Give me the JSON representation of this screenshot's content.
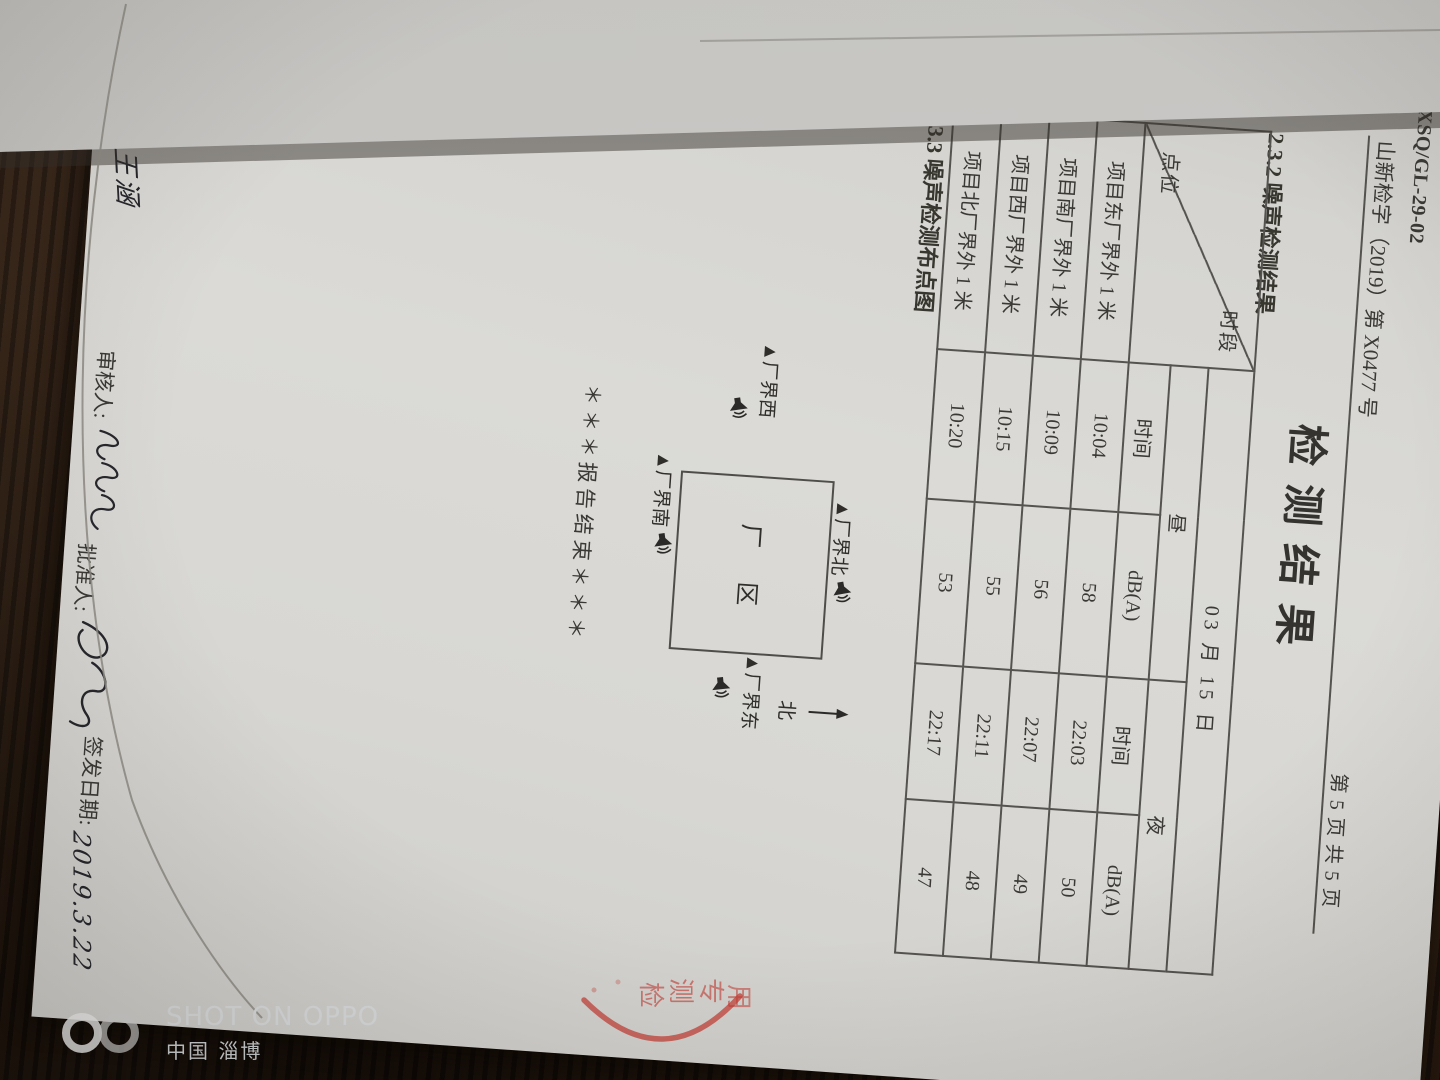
{
  "document": {
    "doc_code": "XSQ/GL-29-02",
    "ref_number": "山新检字（2019）第 X0477 号",
    "page_indicator": "第 5 页  共 5 页",
    "title": "检测结果",
    "section_232": "2.3.2  噪声检测结果",
    "section_233": "2.3.3  噪声检测布点图",
    "report_end": "＊＊＊报告结束＊＊＊",
    "table": {
      "corner_top_label": "时段",
      "corner_bottom_label": "点位",
      "date_header": "03 月 15 日",
      "day_label": "昼",
      "night_label": "夜",
      "time_label": "时间",
      "db_label": "dB(A)",
      "rows": [
        {
          "point": "项目东厂界外 1 米",
          "day_time": "10:04",
          "day_db": "58",
          "night_time": "22:03",
          "night_db": "50"
        },
        {
          "point": "项目南厂界外 1 米",
          "day_time": "10:09",
          "day_db": "56",
          "night_time": "22:07",
          "night_db": "49"
        },
        {
          "point": "项目西厂界外 1 米",
          "day_time": "10:15",
          "day_db": "55",
          "night_time": "22:11",
          "night_db": "48"
        },
        {
          "point": "项目北厂界外 1 米",
          "day_time": "10:20",
          "day_db": "53",
          "night_time": "22:17",
          "night_db": "47"
        }
      ]
    },
    "diagram": {
      "factory_label": "厂区",
      "north_point": "▲厂界北",
      "west_point": "▲厂界西",
      "east_point": "▲厂界东",
      "south_point": "▲厂界南",
      "north_arrow_label": "北"
    },
    "signatures": {
      "preparer_label": "编制人:",
      "preparer_name": "王涵",
      "reviewer_label": "审核人:",
      "approver_label": "批准人:",
      "issue_date_label": "签发日期:",
      "issue_date": "2019.3.22"
    },
    "stamp_chars": [
      "检",
      "测",
      "专",
      "用"
    ]
  },
  "photo": {
    "watermark_line1": "SHOT ON OPPO",
    "watermark_line2": "中国  淄博"
  }
}
